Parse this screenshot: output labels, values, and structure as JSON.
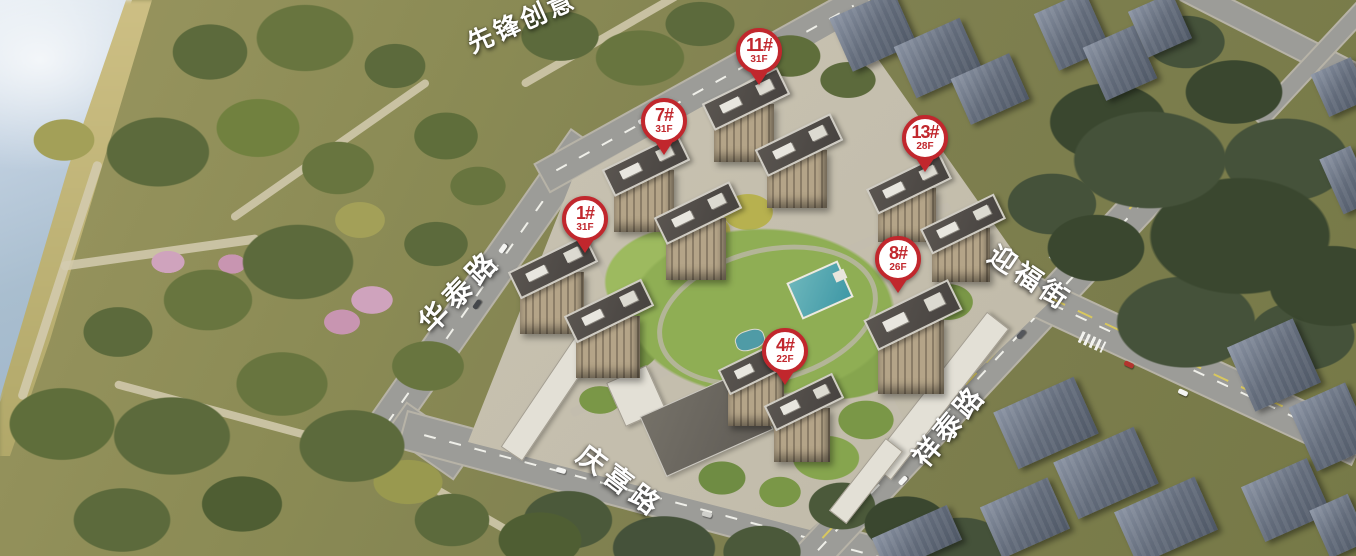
{
  "scene": {
    "description": "aerial masterplan rendering of residential development beside river park"
  },
  "pins": [
    {
      "id": "1#",
      "floors": "31F"
    },
    {
      "id": "7#",
      "floors": "31F"
    },
    {
      "id": "11#",
      "floors": "31F"
    },
    {
      "id": "13#",
      "floors": "28F"
    },
    {
      "id": "8#",
      "floors": "26F"
    },
    {
      "id": "4#",
      "floors": "22F"
    }
  ],
  "road_labels": [
    {
      "name": "先锋创意"
    },
    {
      "name": "华泰路"
    },
    {
      "name": "迎福街"
    },
    {
      "name": "祥泰路"
    },
    {
      "name": "庆喜路"
    }
  ],
  "colors": {
    "pin_red": "#c1272d",
    "label_white": "#ffffff"
  }
}
